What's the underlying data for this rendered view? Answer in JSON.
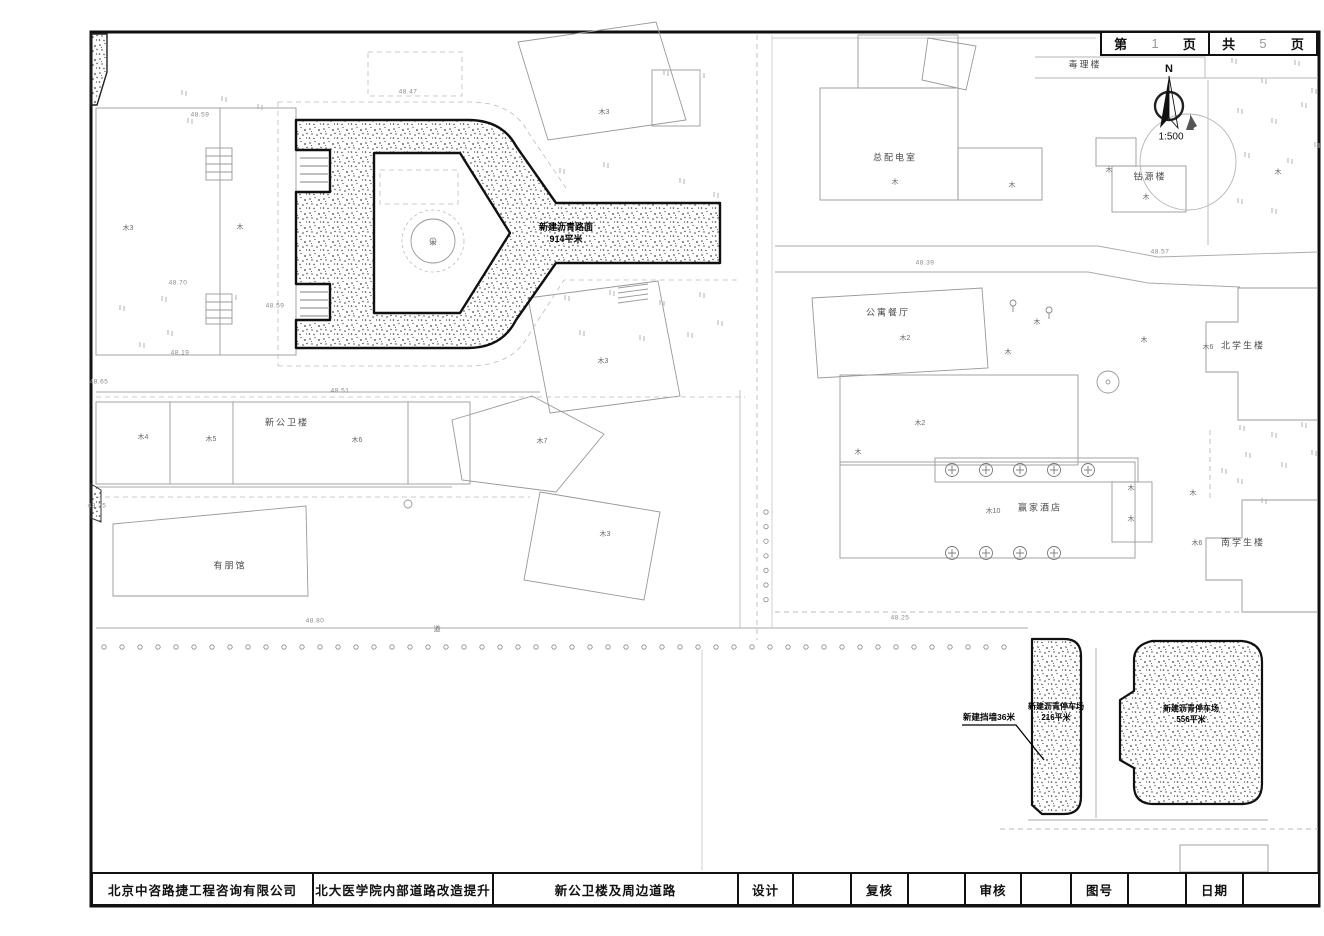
{
  "sheet_box": {
    "page_prefix": "第",
    "page_number": "1",
    "page_suffix": "页",
    "total_prefix": "共",
    "total_number": "5",
    "total_suffix": "页"
  },
  "compass": {
    "north": "N",
    "scale": "1:500"
  },
  "annotations": {
    "new_road": {
      "line1": "新建沥青路面",
      "line2": "914平米"
    },
    "parking_small": {
      "line1": "新建沥青停车场",
      "line2": "216平米"
    },
    "parking_large": {
      "line1": "新建沥青停车场",
      "line2": "556平米"
    },
    "new_wall": {
      "text": "新建挡墙36米"
    },
    "road_char": {
      "text": "道",
      "x": 437,
      "y": 629
    }
  },
  "buildings": [
    {
      "text": "毒理楼",
      "x": 1085,
      "y": 64
    },
    {
      "text": "总配电室",
      "x": 895,
      "y": 157
    },
    {
      "text": "钴源楼",
      "x": 1150,
      "y": 176
    },
    {
      "text": "公寓餐厅",
      "x": 888,
      "y": 312
    },
    {
      "text": "北学生楼",
      "x": 1243,
      "y": 345
    },
    {
      "text": "南学生楼",
      "x": 1243,
      "y": 542
    },
    {
      "text": "赢家酒店",
      "x": 1040,
      "y": 507
    },
    {
      "text": "新公卫楼",
      "x": 287,
      "y": 422
    },
    {
      "text": "有朋馆",
      "x": 230,
      "y": 565
    }
  ],
  "structure_marks": [
    {
      "text": "木3",
      "x": 128,
      "y": 228
    },
    {
      "text": "木",
      "x": 240,
      "y": 227
    },
    {
      "text": "木3",
      "x": 604,
      "y": 112
    },
    {
      "text": "木",
      "x": 433,
      "y": 243
    },
    {
      "text": "木3",
      "x": 603,
      "y": 361
    },
    {
      "text": "木7",
      "x": 542,
      "y": 441
    },
    {
      "text": "木3",
      "x": 605,
      "y": 534
    },
    {
      "text": "木4",
      "x": 143,
      "y": 437
    },
    {
      "text": "木5",
      "x": 211,
      "y": 439
    },
    {
      "text": "木6",
      "x": 357,
      "y": 440
    },
    {
      "text": "木",
      "x": 895,
      "y": 182
    },
    {
      "text": "木",
      "x": 1012,
      "y": 185
    },
    {
      "text": "木",
      "x": 1109,
      "y": 170
    },
    {
      "text": "木",
      "x": 1146,
      "y": 197
    },
    {
      "text": "木",
      "x": 1278,
      "y": 172
    },
    {
      "text": "木2",
      "x": 905,
      "y": 338
    },
    {
      "text": "木",
      "x": 1037,
      "y": 322
    },
    {
      "text": "木",
      "x": 1008,
      "y": 352
    },
    {
      "text": "木",
      "x": 1144,
      "y": 340
    },
    {
      "text": "木2",
      "x": 920,
      "y": 423
    },
    {
      "text": "木",
      "x": 858,
      "y": 452
    },
    {
      "text": "木10",
      "x": 993,
      "y": 511
    },
    {
      "text": "木",
      "x": 1131,
      "y": 488
    },
    {
      "text": "木",
      "x": 1131,
      "y": 519
    },
    {
      "text": "木",
      "x": 1193,
      "y": 493
    },
    {
      "text": "木6",
      "x": 1208,
      "y": 347
    },
    {
      "text": "木6",
      "x": 1197,
      "y": 543
    }
  ],
  "elevations": [
    {
      "text": "48.59",
      "x": 200,
      "y": 115
    },
    {
      "text": "48.47",
      "x": 408,
      "y": 92
    },
    {
      "text": "48.70",
      "x": 178,
      "y": 283
    },
    {
      "text": "48.59",
      "x": 275,
      "y": 306
    },
    {
      "text": "48.19",
      "x": 180,
      "y": 353
    },
    {
      "text": "48.65",
      "x": 99,
      "y": 382
    },
    {
      "text": "48.51",
      "x": 340,
      "y": 391
    },
    {
      "text": "48.35",
      "x": 97,
      "y": 506
    },
    {
      "text": "48.80",
      "x": 315,
      "y": 621
    },
    {
      "text": "48.25",
      "x": 900,
      "y": 618
    },
    {
      "text": "48.39",
      "x": 925,
      "y": 263
    },
    {
      "text": "48.57",
      "x": 1160,
      "y": 252
    }
  ],
  "title_block": {
    "cells": [
      {
        "label": "北京中咨路捷工程咨询有限公司"
      },
      {
        "label": "北大医学院内部道路改造提升"
      },
      {
        "label": "新公卫楼及周边道路"
      },
      {
        "label": "设计"
      },
      {
        "label": ""
      },
      {
        "label": "复核"
      },
      {
        "label": ""
      },
      {
        "label": "审核"
      },
      {
        "label": ""
      },
      {
        "label": "图号"
      },
      {
        "label": ""
      },
      {
        "label": "日期"
      },
      {
        "label": ""
      }
    ]
  },
  "colors": {
    "frame": "#111111",
    "new_construction_outline": "#111111",
    "stipple_dot": "#3c3c3c",
    "building_line": "#999999",
    "dashed_line": "#bbbbbb",
    "label_text": "#4a4a4a"
  }
}
